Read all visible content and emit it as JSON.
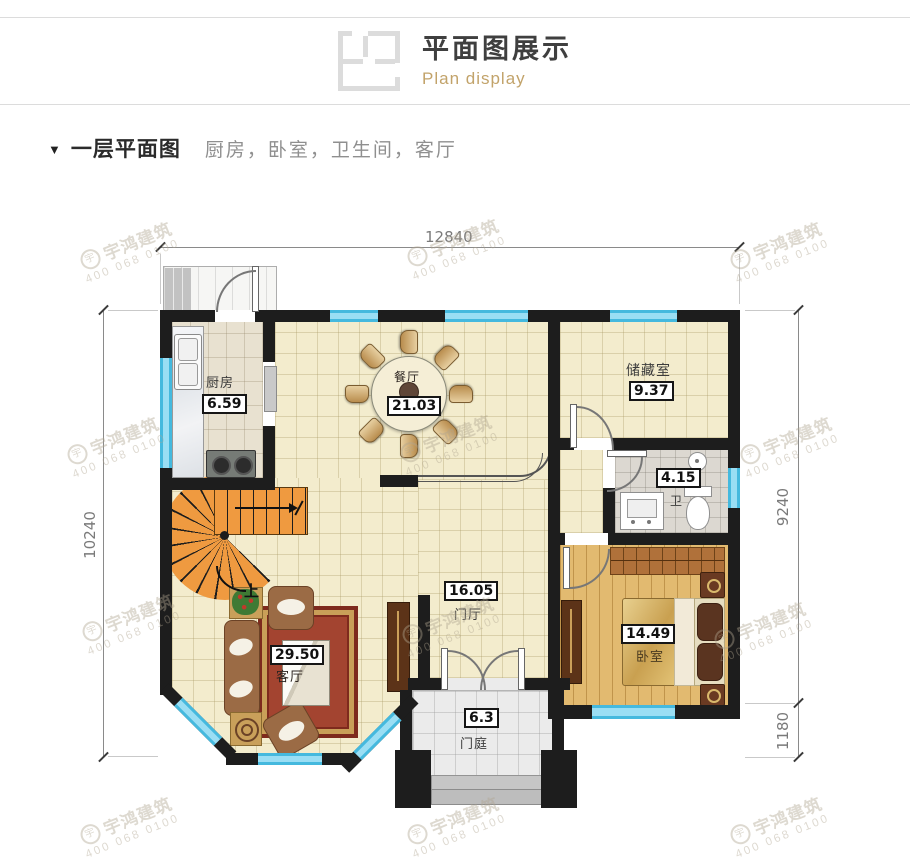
{
  "header": {
    "title": "平面图展示",
    "subtitle": "Plan display"
  },
  "section": {
    "marker": "▼",
    "title": "一层平面图",
    "subtitle": "厨房，卧室，卫生间，客厅"
  },
  "watermark": {
    "brand": "宇鸿建筑",
    "phone": "400 068 0100",
    "logo_glyph": "宇"
  },
  "dimensions": {
    "top": "12840",
    "left": "10240",
    "right_main": "9240",
    "right_lower": "1180"
  },
  "rooms": {
    "kitchen": {
      "name": "厨房",
      "area": "6.59"
    },
    "dining": {
      "name": "餐厅",
      "area": "21.03"
    },
    "storage": {
      "name": "储藏室",
      "area": "9.37"
    },
    "bath": {
      "name": "卫",
      "area": "4.15"
    },
    "foyer": {
      "name": "门厅",
      "area": "16.05"
    },
    "living": {
      "name": "客厅",
      "area": "29.50"
    },
    "bedroom": {
      "name": "卧室",
      "area": "14.49"
    },
    "porch": {
      "name": "门庭",
      "area": "6.3"
    }
  },
  "stairs": {
    "up_label": "上"
  },
  "colors": {
    "wall": "#1d1d1d",
    "window_blue": "#9adef4",
    "accent_gold": "#c2a36a",
    "stairs_orange": "#ef9a40",
    "carpet_red": "#a34430",
    "floor_yellow": "#f3eccd"
  }
}
